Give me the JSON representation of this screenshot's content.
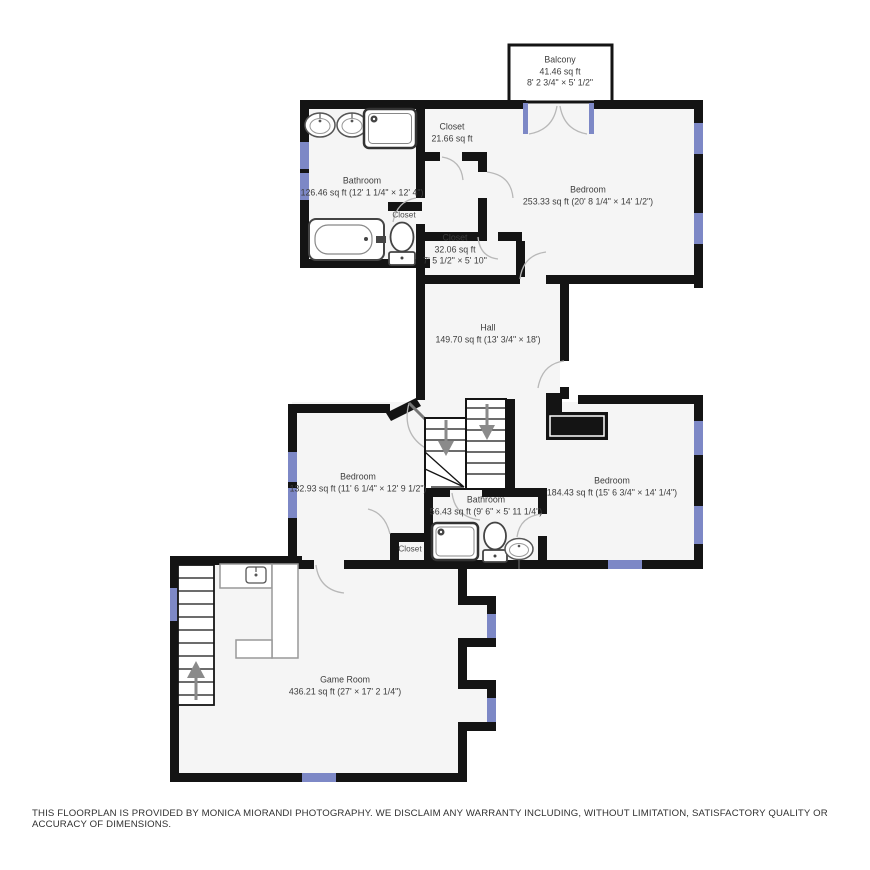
{
  "palette": {
    "wall": "#141414",
    "room_fill": "#f5f5f5",
    "window": "#7d88c6",
    "door_arc": "#b8b8b8",
    "stair_arrow": "#8a8a8a",
    "label_text": "#3d3d3d"
  },
  "rooms": {
    "balcony": {
      "name": "Balcony",
      "area": "41.46 sq ft",
      "dims": "8' 2 3/4\" × 5' 1/2\""
    },
    "closet_top": {
      "name": "Closet",
      "area": "21.66 sq ft"
    },
    "bathroom_upper": {
      "name": "Bathroom",
      "area": "126.46 sq ft (12' 1 1/4\" × 12' 4\")"
    },
    "bedroom_upper": {
      "name": "Bedroom",
      "area": "253.33 sq ft (20' 8 1/4\" × 14' 1/2\")"
    },
    "closet_mid": {
      "name": "Closet"
    },
    "closet_32": {
      "name": "Closet",
      "area": "32.06 sq ft",
      "dims": "7' 5 1/2\" × 5' 10\""
    },
    "hall": {
      "name": "Hall",
      "area": "149.70 sq ft (13' 3/4\" × 18')"
    },
    "bedroom_left": {
      "name": "Bedroom",
      "area": "132.93 sq ft (11' 6 1/4\" × 12' 9 1/2\")"
    },
    "bathroom_lower": {
      "name": "Bathroom",
      "area": "56.43 sq ft (9' 6\" × 5' 11 1/4\")"
    },
    "bedroom_right": {
      "name": "Bedroom",
      "area": "184.43 sq ft (15' 6 3/4\" × 14' 1/4\")"
    },
    "closet_bottom": {
      "name": "Closet"
    },
    "game_room": {
      "name": "Game Room",
      "area": "436.21 sq ft (27' × 17' 2 1/4\")"
    }
  },
  "footer": {
    "disclaimer": "THIS FLOORPLAN IS PROVIDED BY MONICA MIORANDI PHOTOGRAPHY. WE DISCLAIM ANY WARRANTY INCLUDING, WITHOUT LIMITATION, SATISFACTORY QUALITY OR ACCURACY OF DIMENSIONS."
  }
}
